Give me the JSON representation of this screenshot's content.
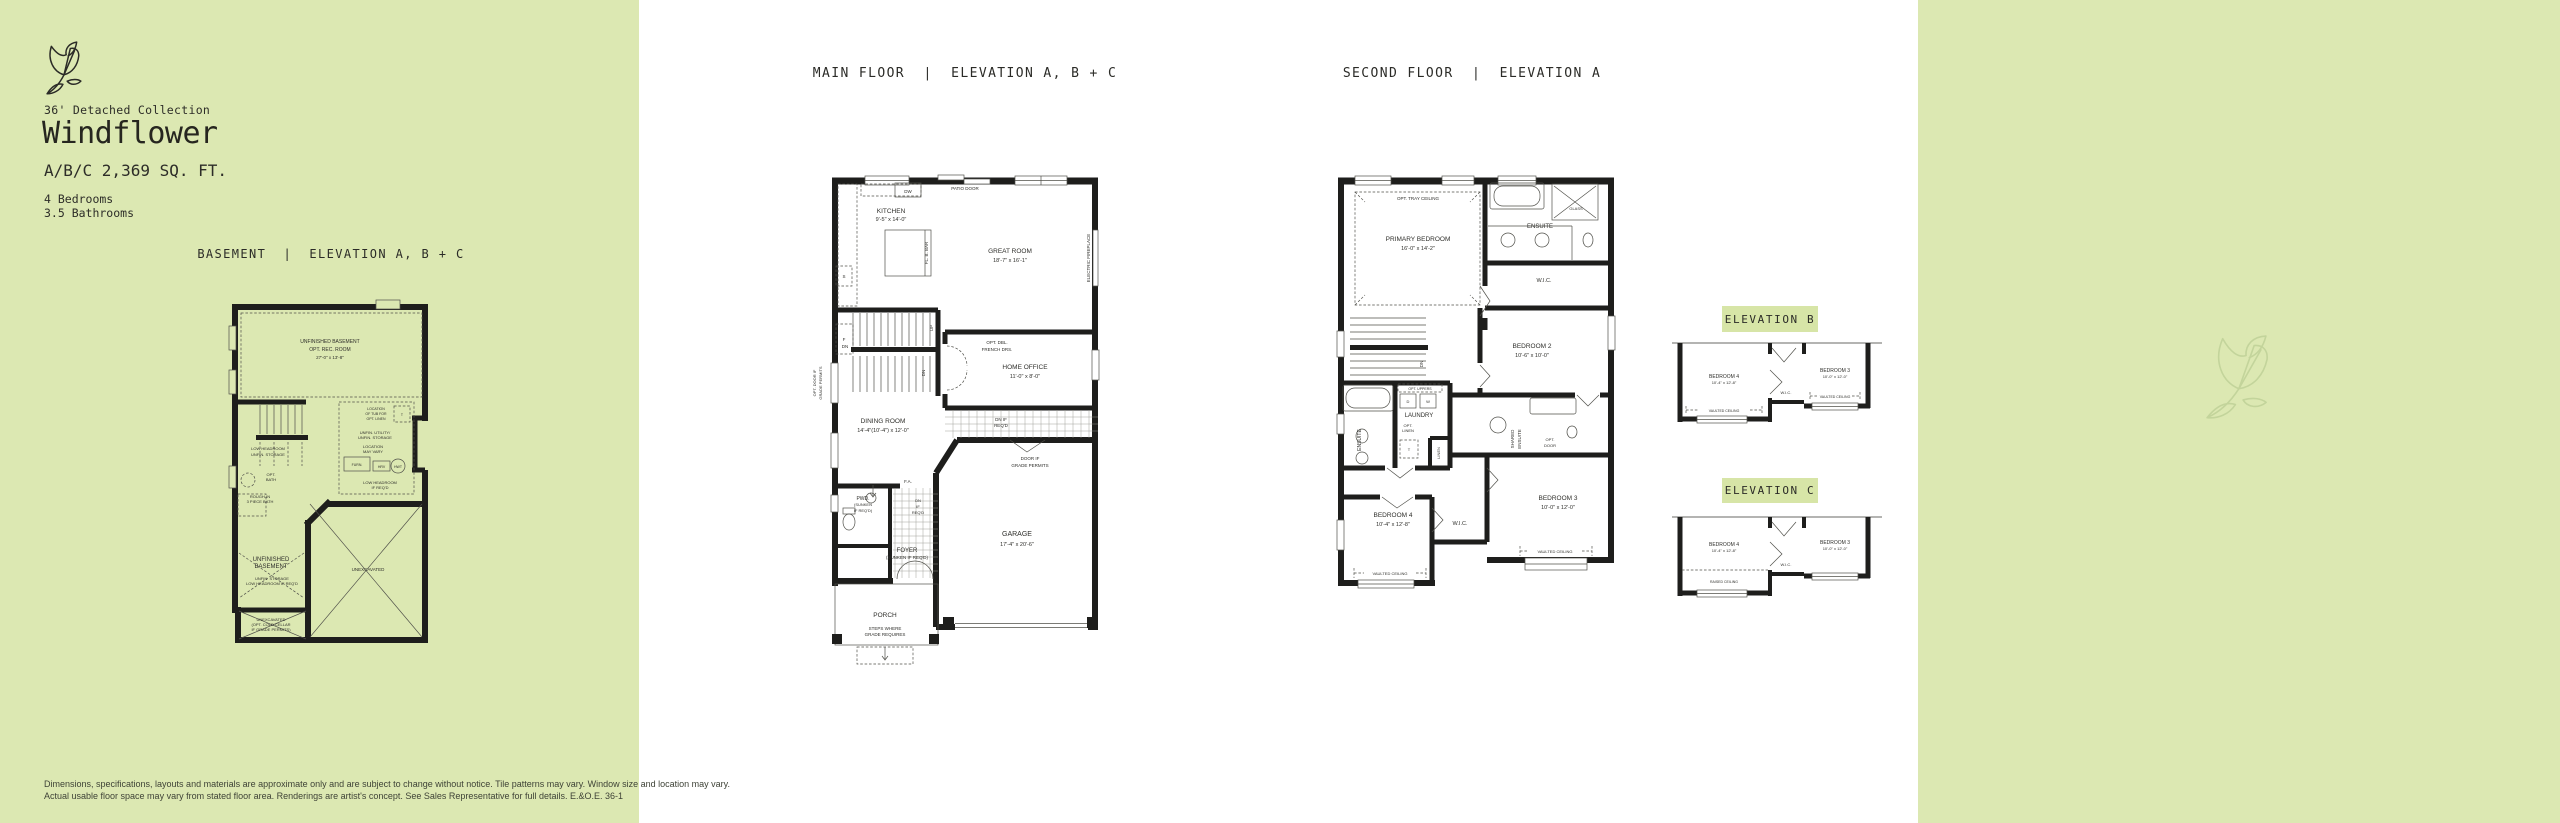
{
  "colors": {
    "panel_green": "#dce8b2",
    "badge_green": "#d7e5a7",
    "ink": "#2b2b27",
    "wall": "#1e1e1c",
    "watermark": "#c3d49b"
  },
  "sidebar": {
    "collection": "36' Detached Collection",
    "title": "Windflower",
    "sqft": "A/B/C 2,369 SQ. FT.",
    "bedrooms": "4 Bedrooms",
    "bathrooms": "3.5 Bathrooms"
  },
  "plans": {
    "basement": {
      "heading": "BASEMENT  |  ELEVATION A, B + C",
      "rec_room": [
        "UNFINISHED BASEMENT",
        "OPT. REC. ROOM",
        "27'-0\" x 13'-8\""
      ],
      "low_headroom_storage": [
        "LOW HEADROOM",
        "UNFIN. STORAGE"
      ],
      "tub_location": [
        "LOCATION",
        "OF TUB FOR",
        "OPT. LINEN"
      ],
      "t_marker": "T",
      "utility": [
        "UNFIN. UTILITY/",
        "UNFIN. STORAGE"
      ],
      "location_vary": [
        "LOCATION",
        "MAY VARY"
      ],
      "furnace": "FURN.",
      "hrv": "HRV",
      "hwt": "HWT",
      "low_headroom_reqd": [
        "LOW HEADROOM",
        "IF REQ'D"
      ],
      "opt_bath": [
        "OPT.",
        "BATH"
      ],
      "rough_in": [
        "ROUGH-IN",
        "3 PIECE BATH"
      ],
      "unfinished": [
        "UNFINISHED",
        "BASEMENT"
      ],
      "unfin_storage": [
        "UNFIN. STORAGE",
        "LOW HEADROOM IF REQ'D"
      ],
      "unexcavated": "UNEXCAVATED",
      "cold_cellar": [
        "UNEXCAVATED",
        "(OPT. COLD CELLAR",
        "IF GRADE PERMITS)"
      ]
    },
    "main": {
      "heading": "MAIN FLOOR  |  ELEVATION A, B + C",
      "patio_door": "PATIO DOOR",
      "dw": "DW",
      "kitchen": [
        "KITCHEN",
        "9'-5\" x 14'-0\""
      ],
      "s": "S",
      "f": "F",
      "flush_bar": "FL. B. BAR",
      "great_room": [
        "GREAT ROOM",
        "18'-7\" x 16'-1\""
      ],
      "fireplace": "ELECTRIC FIREPLACE",
      "up": "UP",
      "dn": "DN",
      "dn2": "DN",
      "opt_door": [
        "OPT. DOOR IF",
        "GRADE PERMITS"
      ],
      "french_doors": [
        "OPT. DBL.",
        "FRENCH DRS."
      ],
      "home_office": [
        "HOME OFFICE",
        "11'-0\" x 8'-0\""
      ],
      "dining": [
        "DINING ROOM",
        "14'-4\"(10'-4\") x 12'-0\""
      ],
      "dn_if_reqd": [
        "DN IF",
        "REQ'D"
      ],
      "door_grade": [
        "DOOR IF",
        "GRADE PERMITS"
      ],
      "fa": "F.A.",
      "pwd": [
        "PWD.",
        "(SUNKEN",
        "IF REQ'D)"
      ],
      "dn_if_reqd2": [
        "DN",
        "IF",
        "REQ'D"
      ],
      "foyer": [
        "FOYER",
        "(SUNKEN IF REQ'D)"
      ],
      "garage": [
        "GARAGE",
        "17'-4\" x 20'-6\""
      ],
      "porch": "PORCH",
      "steps": [
        "STEPS WHERE",
        "GRADE REQUIRES"
      ]
    },
    "second": {
      "heading": "SECOND FLOOR  |  ELEVATION A",
      "opt_tray": "OPT. TRAY CEILING",
      "primary": [
        "PRIMARY BEDROOM",
        "16'-0\" x 14'-2\""
      ],
      "ensuite": "ENSUITE",
      "glass": "GLASS",
      "wic": "W.I.C.",
      "bedroom2": [
        "BEDROOM 2",
        "10'-6\" x 10'-0\""
      ],
      "dn": "DN",
      "ensuite4": "ENSUITE",
      "opt_uppers": "OPT. UPPERS",
      "d": "D",
      "w": "W",
      "laundry": "LAUNDRY",
      "opt_linen": [
        "OPT.",
        "LINEN"
      ],
      "t_marker": "T",
      "linen": "LINEN",
      "shared_ensuite": [
        "SHARED",
        "ENSUITE"
      ],
      "opt_door": [
        "OPT.",
        "DOOR"
      ],
      "bedroom3": [
        "BEDROOM 3",
        "10'-0\" x 12'-0\""
      ],
      "bedroom4": [
        "BEDROOM 4",
        "10'-4\" x 12'-8\""
      ],
      "wic4": "W.I.C.",
      "vaulted3": "VAULTED CEILING",
      "vaulted4": "VAULTED CEILING"
    },
    "elev_b": {
      "badge": "ELEVATION B",
      "bedroom4": [
        "BEDROOM 4",
        "10'-4\" x 12'-8\""
      ],
      "wic": "W.I.C.",
      "bedroom3": [
        "BEDROOM 3",
        "10'-0\" x 12'-0\""
      ],
      "vaulted4": "VAULTED CEILING",
      "vaulted3": "VAULTED CEILING"
    },
    "elev_c": {
      "badge": "ELEVATION C",
      "bedroom4": [
        "BEDROOM 4",
        "10'-4\" x 12'-8\""
      ],
      "wic": "W.I.C.",
      "bedroom3": [
        "BEDROOM 3",
        "10'-0\" x 12'-0\""
      ],
      "raised": "RAISED CEILING"
    }
  },
  "footer": {
    "line1": "Dimensions, specifications, layouts and materials are approximate only and are subject to change without notice. Tile patterns may vary. Window size and location may vary.",
    "line2": "Actual usable floor space may vary from stated floor area. Renderings are artist's concept. See Sales Representative for full details. E.&O.E.  36-1"
  }
}
